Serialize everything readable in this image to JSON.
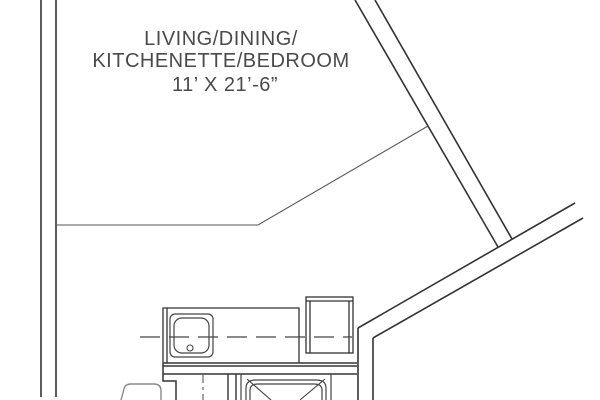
{
  "floor_plan": {
    "room_label": {
      "line1": "LIVING/DINING/",
      "line2": "KITCHENETTE/BEDROOM",
      "dimensions": "11’ X 21’-6”"
    },
    "rooms": [
      {
        "name": "Living / Dining / Kitchenette / Bedroom",
        "size": "11’ X 21’-6”"
      }
    ],
    "fixtures": [
      "kitchenette-counter",
      "kitchen-sink",
      "refrigerator-cabinet",
      "upper-cabinet-dashed-line",
      "shower-stall",
      "bathroom-partition-wall",
      "bathroom-door-centerline",
      "vanity-sink"
    ],
    "colors": {
      "background": "#ffffff",
      "wall_line": "#333333",
      "thin_line": "#555555",
      "fixture_line": "#444444",
      "fixture_gray": "#8a8a8a",
      "text": "#4a4a4a"
    }
  }
}
